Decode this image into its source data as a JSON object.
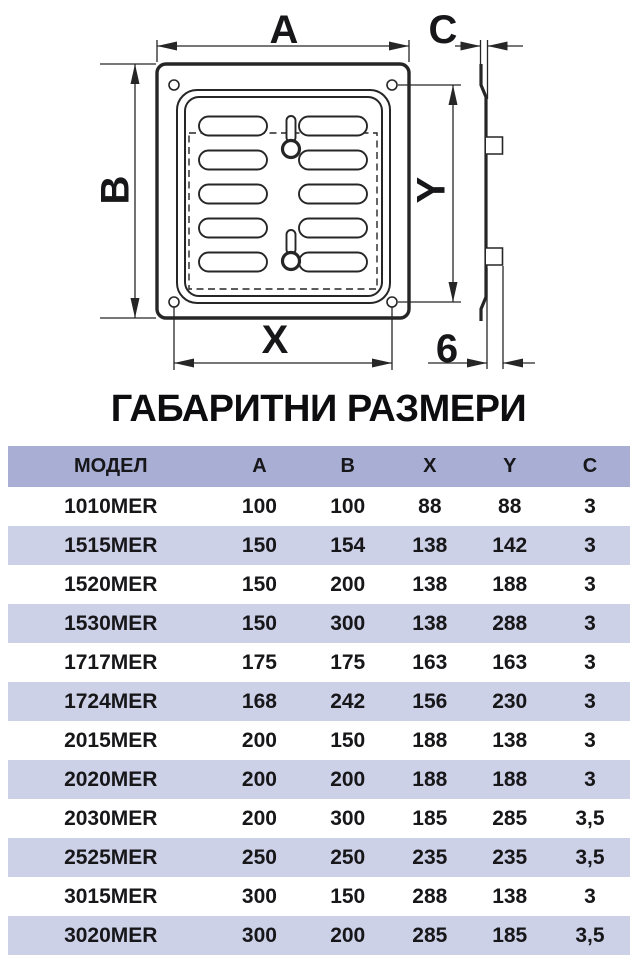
{
  "title": "ГАБАРИТНИ РАЗМЕРИ",
  "diagram": {
    "labels": {
      "a": "A",
      "b": "B",
      "c": "C",
      "x": "X",
      "y": "Y",
      "flange_depth": "6"
    }
  },
  "table": {
    "columns": [
      "МОДЕЛ",
      "A",
      "B",
      "X",
      "Y",
      "C"
    ],
    "rows": [
      [
        "1010MER",
        "100",
        "100",
        "88",
        "88",
        "3"
      ],
      [
        "1515MER",
        "150",
        "154",
        "138",
        "142",
        "3"
      ],
      [
        "1520MER",
        "150",
        "200",
        "138",
        "188",
        "3"
      ],
      [
        "1530MER",
        "150",
        "300",
        "138",
        "288",
        "3"
      ],
      [
        "1717MER",
        "175",
        "175",
        "163",
        "163",
        "3"
      ],
      [
        "1724MER",
        "168",
        "242",
        "156",
        "230",
        "3"
      ],
      [
        "2015MER",
        "200",
        "150",
        "188",
        "138",
        "3"
      ],
      [
        "2020MER",
        "200",
        "200",
        "188",
        "188",
        "3"
      ],
      [
        "2030MER",
        "200",
        "300",
        "185",
        "285",
        "3,5"
      ],
      [
        "2525MER",
        "250",
        "250",
        "235",
        "235",
        "3,5"
      ],
      [
        "3015MER",
        "300",
        "150",
        "288",
        "138",
        "3"
      ],
      [
        "3020MER",
        "300",
        "200",
        "285",
        "185",
        "3,5"
      ]
    ]
  },
  "colors": {
    "header_bg": "#a8aed4",
    "row_alt_bg": "#cdd1e8",
    "row_bg": "#ffffff",
    "text": "#17171a",
    "line": "#262626"
  }
}
